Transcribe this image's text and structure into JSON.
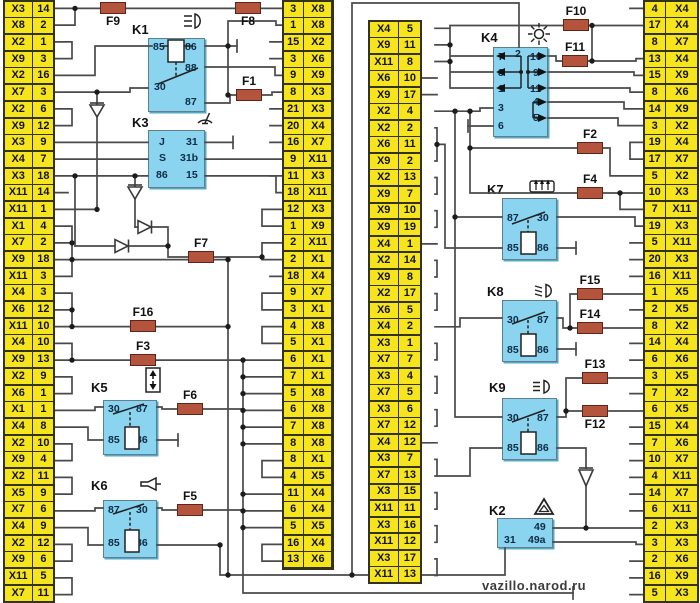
{
  "watermark": "vazillo.narod.ru",
  "colors": {
    "connector_yellow": "#f6e51c",
    "relay_blue": "#8bd4f0",
    "fuse_brick": "#b5543c",
    "wire_gray": "#4a4a4a"
  },
  "columns": {
    "col1": {
      "rows": [
        [
          "X3",
          "14"
        ],
        [
          "X8",
          "2"
        ],
        [
          "X2",
          "1"
        ],
        [
          "X9",
          "3"
        ],
        [
          "X2",
          "16"
        ],
        [
          "X7",
          "3"
        ],
        [
          "X2",
          "6"
        ],
        [
          "X9",
          "12"
        ],
        [
          "X3",
          "9"
        ],
        [
          "X4",
          "7"
        ],
        [
          "X3",
          "18"
        ],
        [
          "X11",
          "14"
        ],
        [
          "X11",
          "1"
        ],
        [
          "X1",
          "4"
        ],
        [
          "X7",
          "2"
        ],
        [
          "X9",
          "18"
        ],
        [
          "X11",
          "3"
        ],
        [
          "X4",
          "3"
        ],
        [
          "X6",
          "12"
        ],
        [
          "X11",
          "10"
        ],
        [
          "X4",
          "10"
        ],
        [
          "X9",
          "13"
        ],
        [
          "X2",
          "9"
        ],
        [
          "X6",
          "1"
        ],
        [
          "X1",
          "1"
        ],
        [
          "X4",
          "8"
        ],
        [
          "X2",
          "10"
        ],
        [
          "X9",
          "4"
        ],
        [
          "X2",
          "11"
        ],
        [
          "X5",
          "9"
        ],
        [
          "X7",
          "6"
        ],
        [
          "X4",
          "9"
        ],
        [
          "X2",
          "12"
        ],
        [
          "X9",
          "6"
        ],
        [
          "X11",
          "5"
        ],
        [
          "X7",
          "11"
        ]
      ]
    },
    "col2": {
      "rows": [
        [
          "3",
          "X8"
        ],
        [
          "1",
          "X8"
        ],
        [
          "15",
          "X2"
        ],
        [
          "3",
          "X6"
        ],
        [
          "9",
          "X9"
        ],
        [
          "8",
          "X3"
        ],
        [
          "21",
          "X3"
        ],
        [
          "20",
          "X4"
        ],
        [
          "16",
          "X7"
        ],
        [
          "9",
          "X11"
        ],
        [
          "11",
          "X3"
        ],
        [
          "18",
          "X11"
        ],
        [
          "12",
          "X3"
        ],
        [
          "1",
          "X9"
        ],
        [
          "2",
          "X11"
        ],
        [
          "2",
          "X1"
        ],
        [
          "18",
          "X4"
        ],
        [
          "9",
          "X7"
        ],
        [
          "3",
          "X1"
        ],
        [
          "4",
          "X8"
        ],
        [
          "5",
          "X1"
        ],
        [
          "6",
          "X1"
        ],
        [
          "7",
          "X1"
        ],
        [
          "5",
          "X8"
        ],
        [
          "6",
          "X8"
        ],
        [
          "7",
          "X8"
        ],
        [
          "8",
          "X8"
        ],
        [
          "8",
          "X1"
        ],
        [
          "4",
          "X5"
        ],
        [
          "11",
          "X4"
        ],
        [
          "6",
          "X4"
        ],
        [
          "5",
          "X5"
        ],
        [
          "16",
          "X4"
        ],
        [
          "13",
          "X6"
        ]
      ]
    },
    "col3": {
      "rows": [
        [
          "X4",
          "5"
        ],
        [
          "X9",
          "11"
        ],
        [
          "X11",
          "8"
        ],
        [
          "X6",
          "10"
        ],
        [
          "X9",
          "17"
        ],
        [
          "X2",
          "4"
        ],
        [
          "X2",
          "2"
        ],
        [
          "X6",
          "11"
        ],
        [
          "X9",
          "2"
        ],
        [
          "X2",
          "13"
        ],
        [
          "X9",
          "7"
        ],
        [
          "X9",
          "10"
        ],
        [
          "X9",
          "19"
        ],
        [
          "X4",
          "1"
        ],
        [
          "X2",
          "14"
        ],
        [
          "X9",
          "8"
        ],
        [
          "X2",
          "17"
        ],
        [
          "X6",
          "5"
        ],
        [
          "X4",
          "2"
        ],
        [
          "X3",
          "1"
        ],
        [
          "X7",
          "7"
        ],
        [
          "X3",
          "4"
        ],
        [
          "X7",
          "5"
        ],
        [
          "X3",
          "6"
        ],
        [
          "X7",
          "12"
        ],
        [
          "X4",
          "12"
        ],
        [
          "X3",
          "7"
        ],
        [
          "X7",
          "13"
        ],
        [
          "X3",
          "15"
        ],
        [
          "X11",
          "11"
        ],
        [
          "X3",
          "16"
        ],
        [
          "X11",
          "12"
        ],
        [
          "X3",
          "17"
        ],
        [
          "X11",
          "13"
        ]
      ]
    },
    "col4": {
      "rows": [
        [
          "4",
          "X4"
        ],
        [
          "17",
          "X4"
        ],
        [
          "8",
          "X7"
        ],
        [
          "13",
          "X4"
        ],
        [
          "15",
          "X9"
        ],
        [
          "8",
          "X6"
        ],
        [
          "14",
          "X9"
        ],
        [
          "3",
          "X2"
        ],
        [
          "19",
          "X4"
        ],
        [
          "17",
          "X7"
        ],
        [
          "5",
          "X2"
        ],
        [
          "10",
          "X3"
        ],
        [
          "7",
          "X11"
        ],
        [
          "19",
          "X3"
        ],
        [
          "5",
          "X11"
        ],
        [
          "20",
          "X3"
        ],
        [
          "16",
          "X11"
        ],
        [
          "1",
          "X5"
        ],
        [
          "2",
          "X5"
        ],
        [
          "8",
          "X2"
        ],
        [
          "14",
          "X4"
        ],
        [
          "6",
          "X6"
        ],
        [
          "3",
          "X5"
        ],
        [
          "7",
          "X2"
        ],
        [
          "6",
          "X5"
        ],
        [
          "15",
          "X4"
        ],
        [
          "7",
          "X6"
        ],
        [
          "10",
          "X7"
        ],
        [
          "4",
          "X11"
        ],
        [
          "14",
          "X7"
        ],
        [
          "6",
          "X11"
        ],
        [
          "2",
          "X3"
        ],
        [
          "3",
          "X3"
        ],
        [
          "2",
          "X6"
        ],
        [
          "16",
          "X9"
        ],
        [
          "5",
          "X3"
        ]
      ]
    }
  },
  "relays": {
    "k1": {
      "label": "K1",
      "icon": "high-beam-icon",
      "pins": {
        "p85": "85",
        "p86": "86",
        "p88": "88",
        "p30": "30",
        "p87": "87"
      }
    },
    "k2": {
      "label": "K2",
      "icon": "hazard-warning-icon",
      "pins": {
        "p49": "49",
        "p31": "31",
        "p49a": "49a"
      }
    },
    "k3": {
      "label": "K3",
      "icon": "wiper-icon",
      "pins": {
        "pj": "J",
        "ps": "S",
        "p86": "86",
        "p31": "31",
        "p31b": "31b",
        "p15": "15"
      }
    },
    "k4": {
      "label": "K4",
      "icon": "turn-signal-flasher-icon",
      "pins": {
        "p2": "2",
        "p7": "7",
        "p8": "8",
        "p1": "1",
        "p3": "3",
        "p6": "6",
        "p10": "10",
        "p9": "9",
        "p11": "11",
        "p4": "4",
        "p5": "5"
      }
    },
    "k5": {
      "label": "K5",
      "icon": "power-window-icon",
      "pins": {
        "p30": "30",
        "p87": "87",
        "p85": "85",
        "p86": "86"
      }
    },
    "k6": {
      "label": "K6",
      "icon": "horn-icon",
      "pins": {
        "p87": "87",
        "p30": "30",
        "p85": "85",
        "p86": "86"
      }
    },
    "k7": {
      "label": "K7",
      "icon": "heated-rear-window-icon",
      "pins": {
        "p87": "87",
        "p30": "30",
        "p85": "85",
        "p86": "86"
      }
    },
    "k8": {
      "label": "K8",
      "icon": "headlight-low-beam-icon",
      "pins": {
        "p30": "30",
        "p87": "87",
        "p85": "85",
        "p86": "86"
      }
    },
    "k9": {
      "label": "K9",
      "icon": "headlight-high-beam-icon",
      "pins": {
        "p30": "30",
        "p87": "87",
        "p85": "85",
        "p86": "86"
      }
    }
  },
  "fuses": {
    "f1": "F1",
    "f2": "F2",
    "f3": "F3",
    "f4": "F4",
    "f5": "F5",
    "f6": "F6",
    "f7": "F7",
    "f8": "F8",
    "f9": "F9",
    "f10": "F10",
    "f11": "F11",
    "f12": "F12",
    "f13": "F13",
    "f14": "F14",
    "f15": "F15",
    "f16": "F16"
  }
}
